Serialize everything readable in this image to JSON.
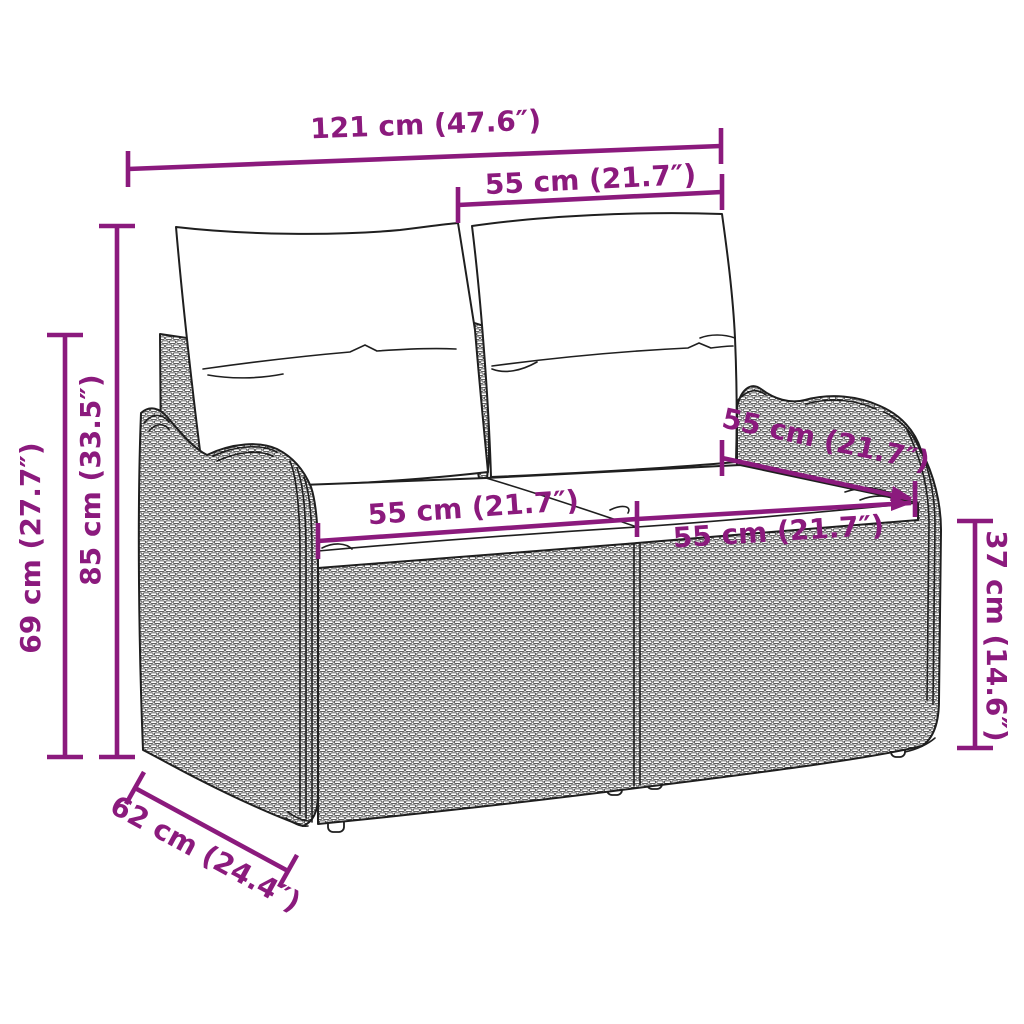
{
  "page": {
    "type": "product dimension diagram",
    "subject": "poly rattan 2-seater garden sofa with cushions",
    "background": "#ffffff"
  },
  "colors": {
    "accent": "#8B1A7D",
    "line": "#1f1f1f"
  },
  "dimensions": {
    "total_width": {
      "label": "121 cm (47.6″)",
      "value_cm": 121,
      "value_in": 47.6
    },
    "backrest_width": {
      "label": "55 cm (21.7″)",
      "value_cm": 55,
      "value_in": 21.7
    },
    "total_height": {
      "label": "85 cm (33.5″)",
      "value_cm": 85,
      "value_in": 33.5
    },
    "side_height": {
      "label": "69 cm (27.7″)",
      "value_cm": 69,
      "value_in": 27.7
    },
    "seat_width_left": {
      "label": "55 cm (21.7″)",
      "value_cm": 55,
      "value_in": 21.7
    },
    "seat_depth": {
      "label": "55 cm (21.7″)",
      "value_cm": 55,
      "value_in": 21.7
    },
    "seat_width_right": {
      "label": "55 cm (21.7″)",
      "value_cm": 55,
      "value_in": 21.7
    },
    "seat_height": {
      "label": "37 cm (14.6″)",
      "value_cm": 37,
      "value_in": 14.6
    },
    "base_depth": {
      "label": "62 cm (24.4″)",
      "value_cm": 62,
      "value_in": 24.4
    }
  }
}
